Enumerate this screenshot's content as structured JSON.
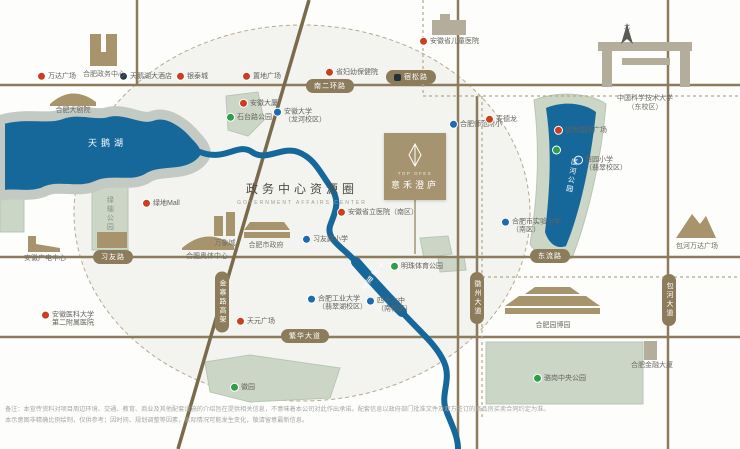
{
  "map": {
    "title": {
      "zh": "政务中心资源圈",
      "en": "GOVERNMENT AFFAIRS CENTER"
    },
    "project": {
      "en": "TOP OFES",
      "zh": "意禾澄庐",
      "logo_icon": "leaf-diamond-icon"
    },
    "compass_label": "北",
    "colors": {
      "road": "#8d7c5c",
      "road_diagonal": "#7b6b4d",
      "water": "#16689b",
      "park": "#ccd6c6",
      "shore": "#c3cac4",
      "circle_fill": "#efefec",
      "accent_box": "#a6936f",
      "marker_red": "#c8401f",
      "marker_blue": "#1c6ab0",
      "marker_green": "#2f9e49",
      "marker_navy": "#2b3a4a"
    },
    "water_labels": [
      {
        "text": "天鹅湖",
        "x": 88,
        "y": 136,
        "style": "lake"
      },
      {
        "text": "匡河公园",
        "x": 566,
        "y": 158,
        "style": "vert",
        "rot": 10
      },
      {
        "text": "十五里河",
        "x": 366,
        "y": 258,
        "style": "vert",
        "rot": 38
      }
    ],
    "road_pills": [
      {
        "text": "南二环路",
        "x": 330,
        "y": 86
      },
      {
        "text": "宿松路",
        "x": 411,
        "y": 77,
        "station": true
      },
      {
        "text": "习友路",
        "x": 113,
        "y": 257
      },
      {
        "text": "东流路",
        "x": 550,
        "y": 256
      },
      {
        "text": "繁华大道",
        "x": 305,
        "y": 336
      },
      {
        "text": "金寨路高架",
        "x": 222,
        "y": 302,
        "vertical": true
      },
      {
        "text": "徽州大道",
        "x": 477,
        "y": 298,
        "vertical": true
      },
      {
        "text": "包河大道",
        "x": 669,
        "y": 300,
        "vertical": true
      }
    ],
    "pois": [
      {
        "type": "mall",
        "text": "万达广场",
        "x": 38,
        "y": 77
      },
      {
        "type": "hotel",
        "text": "天鹅湖大酒店",
        "x": 120,
        "y": 77
      },
      {
        "type": "mall",
        "text": "银泰城",
        "x": 177,
        "y": 77
      },
      {
        "type": "mall",
        "text": "置地广场",
        "x": 243,
        "y": 77
      },
      {
        "type": "mall",
        "text": "省妇幼保健院",
        "x": 326,
        "y": 73
      },
      {
        "type": "mall",
        "text": "安徽大厦",
        "x": 240,
        "y": 104
      },
      {
        "type": "park",
        "text": "石台路公园",
        "x": 227,
        "y": 118
      },
      {
        "type": "school",
        "text": "安徽大学\n（龙河校区）",
        "x": 274,
        "y": 117
      },
      {
        "type": "hospital",
        "text": "安徽省儿童医院",
        "x": 420,
        "y": 42
      },
      {
        "type": "school",
        "text": "合肥师范附小",
        "x": 450,
        "y": 125
      },
      {
        "type": "mall",
        "text": "麦德龙",
        "x": 486,
        "y": 120
      },
      {
        "type": "mall",
        "text": "加侨国际广场",
        "x": 555,
        "y": 131
      },
      {
        "type": "park",
        "text": "",
        "x": 553,
        "y": 150
      },
      {
        "type": "school",
        "text": "西园小学\n（翡翠校区）",
        "x": 575,
        "y": 165
      },
      {
        "type": "school",
        "text": "合肥市实验小学\n（南区）",
        "x": 502,
        "y": 227
      },
      {
        "type": "mall",
        "text": "绿地Mall",
        "x": 143,
        "y": 204
      },
      {
        "type": "school",
        "text": "习友路小学",
        "x": 303,
        "y": 240
      },
      {
        "type": "mall",
        "text": "安徽省立医院（南区）",
        "x": 338,
        "y": 213
      },
      {
        "type": "hospital",
        "text": "安徽医科大学\n第二附属医院",
        "x": 42,
        "y": 320
      },
      {
        "type": "school",
        "text": "合肥工业大学\n（翡翠湖校区）",
        "x": 308,
        "y": 304
      },
      {
        "type": "mall",
        "text": "天元广场",
        "x": 237,
        "y": 322
      },
      {
        "type": "school",
        "text": "四十六中\n（南校区）",
        "x": 367,
        "y": 306
      },
      {
        "type": "park",
        "text": "明珠体育公园",
        "x": 391,
        "y": 267
      },
      {
        "type": "park",
        "text": "徽园",
        "x": 231,
        "y": 388
      },
      {
        "type": "park",
        "text": "骆岗中央公园",
        "x": 534,
        "y": 379
      }
    ],
    "place_labels": [
      {
        "text": "合肥政务中心",
        "x": 104,
        "y": 71
      },
      {
        "text": "合肥大剧院",
        "x": 73,
        "y": 107
      },
      {
        "text": "中国科学技术大学\n（东校区）",
        "x": 645,
        "y": 95
      },
      {
        "text": "安徽广电中心",
        "x": 45,
        "y": 255
      },
      {
        "text": "安徽博物院",
        "x": 112,
        "y": 255
      },
      {
        "text": "合肥奥体中心",
        "x": 207,
        "y": 253
      },
      {
        "text": "万象城",
        "x": 225,
        "y": 240
      },
      {
        "text": "合肥市政府",
        "x": 266,
        "y": 242
      },
      {
        "text": "合肥园博园",
        "x": 553,
        "y": 322
      },
      {
        "text": "合肥金融大厦",
        "x": 652,
        "y": 362
      },
      {
        "text": "包河万达广场",
        "x": 697,
        "y": 243
      },
      {
        "text": "绿轴公园",
        "x": 109,
        "y": 196,
        "vertical": true
      }
    ],
    "disclaimer": "备注：本宣传资料对项目周边环境、交通、教育、商业及其他配套设施的介绍旨在提供相关信息，不意味着本公司对此作出承诺。配套信息以政府部门批准文件及双方签订的商品房买卖合同约定为准。\n本示意图非精确比例绘制，仅供参考；因时间、规划调整等因素，实际情况可能发生变化，敬请留意最新信息。"
  }
}
